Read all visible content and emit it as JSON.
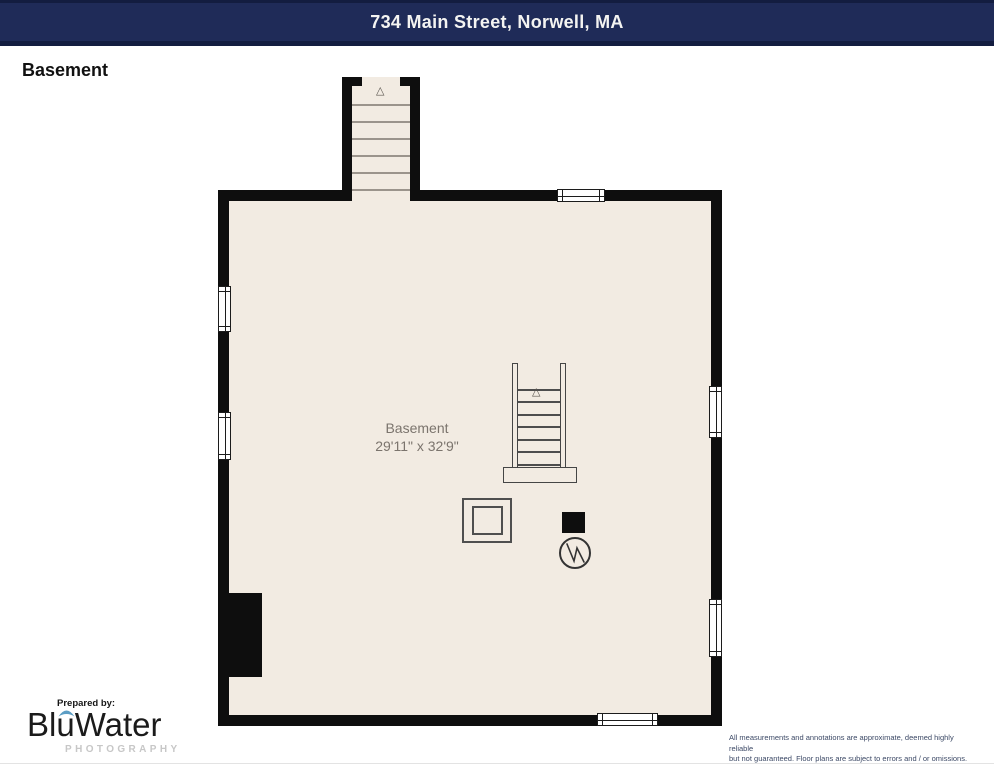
{
  "header": {
    "address": "734 Main Street, Norwell, MA"
  },
  "plan": {
    "floor_label": "Basement",
    "room": {
      "name": "Basement",
      "dimensions": "29'11\" x 32'9\""
    },
    "symbols": {
      "stairs_direction_marker": "triangle-up",
      "water_heater": "circle-with-zigzag",
      "furnace": "double-square",
      "chimney": "solid-black-rect"
    }
  },
  "footer": {
    "prepared_by": "Prepared by:",
    "brand_name": "BluWater",
    "brand_subtitle": "PHOTOGRAPHY",
    "disclaimer_line1": "All measurements and annotations are approximate, deemed highly reliable",
    "disclaimer_line2": "but not guaranteed. Floor plans are subject to errors and / or omissions."
  },
  "colors": {
    "header_bg": "#1f2b58",
    "header_border": "#131d40",
    "wall": "#0e0e0e",
    "floor": "#f2ebe2",
    "room_label": "#7b746d",
    "brand_accent": "#5b9dc4",
    "photography_gray": "#c7c7c7"
  }
}
